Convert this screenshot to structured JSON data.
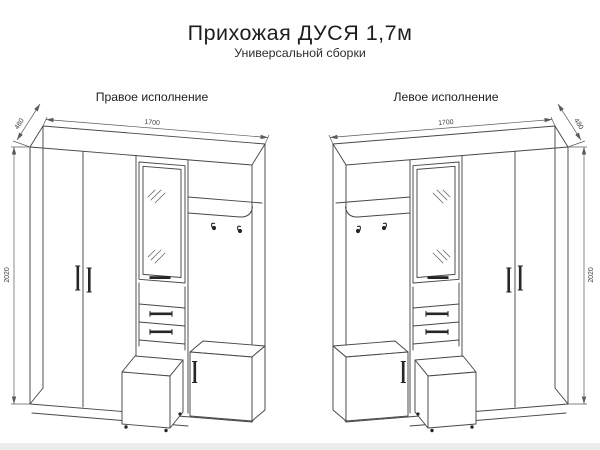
{
  "title": "Прихожая ДУСЯ 1,7м",
  "subtitle": "Универсальной сборки",
  "diagrams": {
    "left": {
      "label": "Правое исполнение",
      "dims": {
        "width": "1700",
        "depth": "480",
        "height": "2020"
      }
    },
    "right": {
      "label": "Левое исполнение",
      "dims": {
        "width": "1700",
        "depth": "480",
        "height": "2020"
      }
    }
  },
  "style": {
    "line_color": "#474747",
    "background": "#ffffff"
  }
}
